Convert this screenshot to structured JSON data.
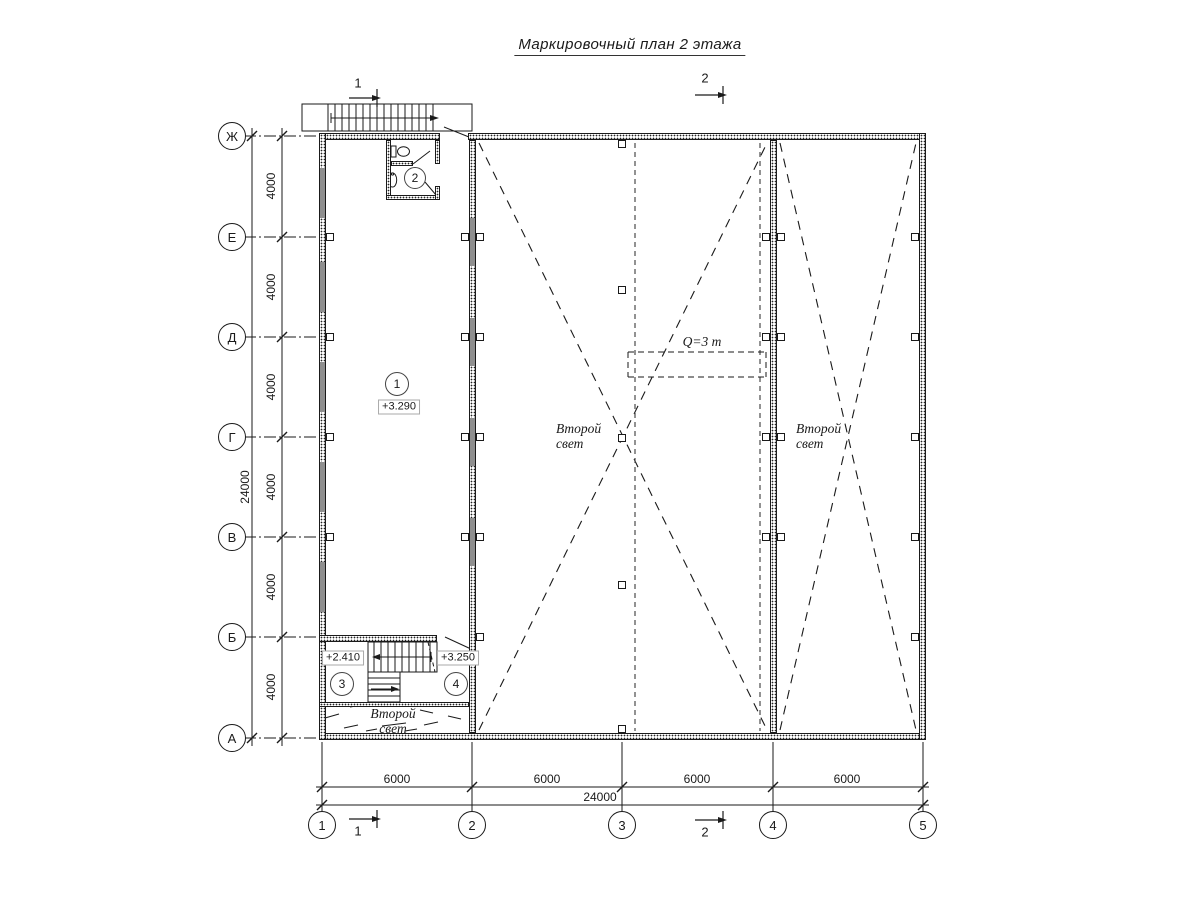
{
  "title": "Маркировочный план 2 этажа",
  "colors": {
    "line": "#1a1a1a",
    "window_fill": "#8f8f8f",
    "paper": "#ffffff"
  },
  "axes": {
    "rows": [
      {
        "label": "Ж"
      },
      {
        "label": "Е"
      },
      {
        "label": "Д"
      },
      {
        "label": "Г"
      },
      {
        "label": "В"
      },
      {
        "label": "Б"
      },
      {
        "label": "А"
      }
    ],
    "cols": [
      {
        "label": "1"
      },
      {
        "label": "2"
      },
      {
        "label": "3"
      },
      {
        "label": "4"
      },
      {
        "label": "5"
      }
    ]
  },
  "dims": {
    "left_segments": [
      "4000",
      "4000",
      "4000",
      "4000",
      "4000",
      "4000"
    ],
    "left_total": "24000",
    "bottom_segments": [
      "6000",
      "6000",
      "6000",
      "6000"
    ],
    "bottom_total": "24000"
  },
  "sections": [
    {
      "label": "1"
    },
    {
      "label": "2"
    }
  ],
  "rooms": [
    {
      "number": "1",
      "level": "+3.290"
    },
    {
      "number": "2"
    },
    {
      "number": "3",
      "level": "+2.410"
    },
    {
      "number": "4",
      "level": "+3.250"
    }
  ],
  "annotations": {
    "second_light_line1": "Второй",
    "second_light_line2": "свет",
    "crane_capacity": "Q=3 т"
  }
}
